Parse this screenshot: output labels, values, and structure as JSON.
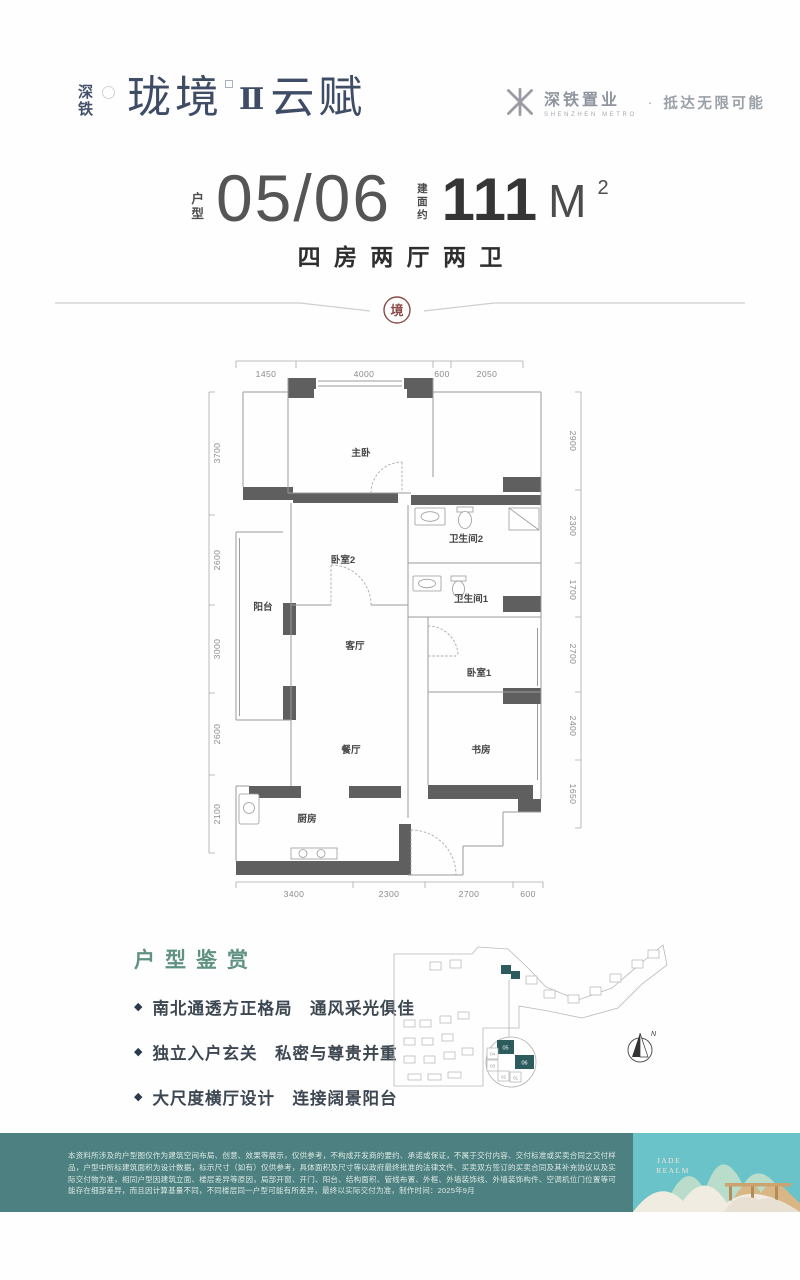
{
  "brand": {
    "stack_chars": [
      "深",
      "铁"
    ],
    "main": "珑境",
    "numeral": "Ⅱ",
    "suffix": "云赋",
    "right_name": "深铁置业",
    "right_en": "SHENZHEN METRO",
    "separator": "·",
    "slogan": "抵达无限可能"
  },
  "title": {
    "unit_label_chars": [
      "户",
      "型"
    ],
    "number": "05/06",
    "area_label_chars": [
      "建",
      "面",
      "约"
    ],
    "area_number": "111",
    "area_unit": "M",
    "area_sup": "2",
    "subtitle": "四房两厅两卫",
    "seal_char": "境"
  },
  "floorplan": {
    "rooms": {
      "master": "主卧",
      "bedroom2": "卧室2",
      "bath2": "卫生间2",
      "balcony": "阳台",
      "living": "客厅",
      "bath1": "卫生间1",
      "bedroom1": "卧室1",
      "dining": "餐厅",
      "study": "书房",
      "kitchen": "厨房"
    },
    "dims_top": [
      "1450",
      "4000",
      "600",
      "2050"
    ],
    "dims_bottom": [
      "3400",
      "2300",
      "2700",
      "600"
    ],
    "dims_left": [
      "3700",
      "2600",
      "3000",
      "2600",
      "2100"
    ],
    "dims_right": [
      "2900",
      "2300",
      "1700",
      "2700",
      "2400",
      "1650"
    ]
  },
  "features": {
    "heading": "户型鉴赏",
    "bullet": "◆",
    "items": [
      "南北通透方正格局　通风采光俱佳",
      "独立入户玄关　私密与尊贵并重",
      "大尺度横厅设计　连接阔景阳台",
      "5开间朝南多面采光　健康生活优选"
    ]
  },
  "siteplan": {
    "units": {
      "u05": "05",
      "u06": "06",
      "u04": "04",
      "u03": "03",
      "u02": "02",
      "u01": "01"
    },
    "compass_label": "N"
  },
  "footer": {
    "disclaimer": "本资料所涉及的户型图仅作为建筑空间布局、创意、效果等展示，仅供参考，不构成开发商的要约、承诺或保证，不属于交付内容、交付标准或买卖合同之交付样品，户型中所标建筑面积为设计数据，标示尺寸（如有）仅供参考，具体面积及尺寸等以政府最终批准的法律文件、买卖双方签订的买卖合同及其补充协议以及实际交付物为准，相同户型因建筑立面、楼层差异等原因，局部开窗、开门、阳台、结构面积、管线布置、外框、外墙装饰线、外墙装饰构件、空调机位门位置等可能存在细部差异，而且因计算基量不同，不同楼层同一户型可能有所差异，最终以实际交付为准，制作时间：2025年9月",
    "art_line1": "JADE",
    "art_line2": "REALM"
  },
  "colors": {
    "brand_navy": "#3f4c66",
    "teal_heading": "#5f9282",
    "seal_red": "#8a4b47",
    "wall_gray": "#5f5f5f",
    "footer_band": "#4d8181",
    "art_background": "#69c3c9",
    "unit_highlight": "#2d5c5e"
  }
}
